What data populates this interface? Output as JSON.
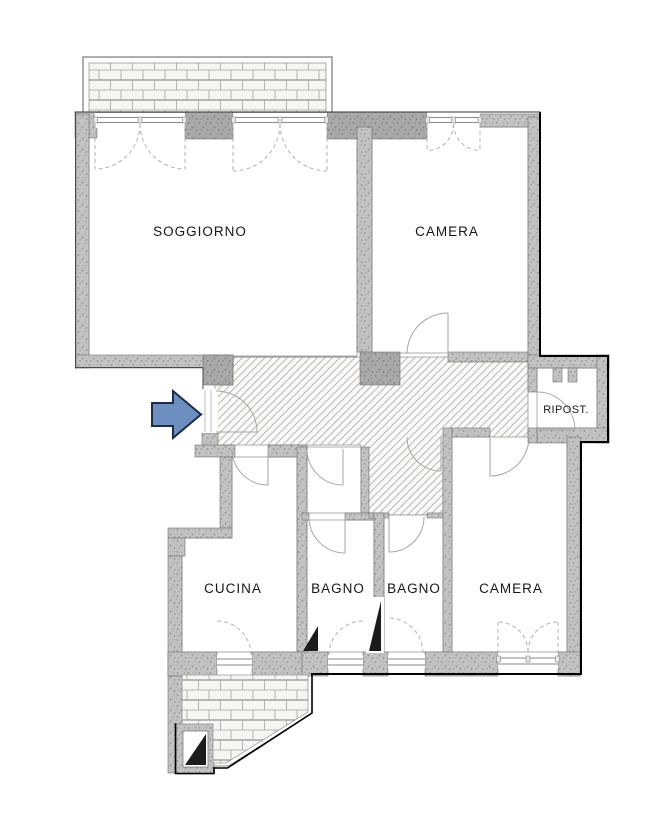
{
  "floorplan": {
    "rooms": {
      "soggiorno": "SOGGIORNO",
      "camera_top": "CAMERA",
      "ripostiglio": "RIPOST.",
      "cucina": "CUCINA",
      "bagno_1": "BAGNO",
      "bagno_2": "BAGNO",
      "camera_bottom": "CAMERA"
    },
    "colors": {
      "arrow_fill": "#6d8fbf",
      "arrow_outline": "#1e2c49",
      "wall_gray": "#bcbcbc",
      "hatch_line": "#b4b1ac",
      "brick_line": "#a3a3a3",
      "label": "#161616"
    }
  }
}
